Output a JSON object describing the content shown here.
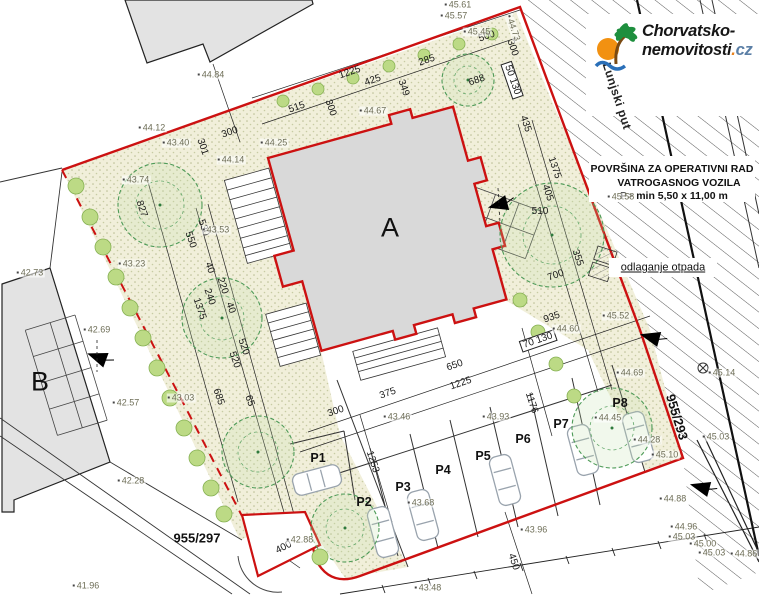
{
  "logo": {
    "brand_line1": "Chorvatsko-",
    "brand_line2": "nemovitosti",
    "brand_suffix_dot": ".",
    "brand_suffix": "cz",
    "icon": "palm-beach-icon",
    "accent_orange": "#e8821e",
    "accent_blue": "#5b7fa6"
  },
  "plan": {
    "boundary_color": "#cc1111",
    "building_fill": "#d9d9d9",
    "labels": [
      {
        "t": "A",
        "x": 390,
        "y": 228,
        "r": 0,
        "c": "bldg"
      },
      {
        "t": "B",
        "x": 40,
        "y": 382,
        "r": 0,
        "c": "bldg"
      },
      {
        "t": "955/297",
        "x": 197,
        "y": 538,
        "r": 0,
        "c": "parcel"
      },
      {
        "t": "955/293",
        "x": 677,
        "y": 417,
        "r": 73,
        "c": "parcel"
      },
      {
        "t": "Lunjski put",
        "x": 617,
        "y": 96,
        "r": 72,
        "c": "road"
      },
      {
        "t": "POVRŠINA ZA OPERATIVNI RAD",
        "x": 672,
        "y": 169,
        "r": 0,
        "c": "note"
      },
      {
        "t": "VATROGASNOG VOZILA",
        "x": 679,
        "y": 183,
        "r": 0,
        "c": "note"
      },
      {
        "t": "P> min 5,50 x 11,00 m",
        "x": 674,
        "y": 196,
        "r": 0,
        "c": "note"
      },
      {
        "t": "odlaganje otpada",
        "x": 663,
        "y": 268,
        "r": 0,
        "c": "noteu"
      },
      {
        "t": "P1",
        "x": 318,
        "y": 458,
        "r": 0,
        "c": "park"
      },
      {
        "t": "P2",
        "x": 364,
        "y": 502,
        "r": 0,
        "c": "park"
      },
      {
        "t": "P3",
        "x": 403,
        "y": 487,
        "r": 0,
        "c": "park"
      },
      {
        "t": "P4",
        "x": 443,
        "y": 470,
        "r": 0,
        "c": "park"
      },
      {
        "t": "P5",
        "x": 483,
        "y": 456,
        "r": 0,
        "c": "park"
      },
      {
        "t": "P6",
        "x": 523,
        "y": 439,
        "r": 0,
        "c": "park"
      },
      {
        "t": "P7",
        "x": 561,
        "y": 424,
        "r": 0,
        "c": "park"
      },
      {
        "t": "P8",
        "x": 620,
        "y": 403,
        "r": 0,
        "c": "park"
      },
      {
        "t": "500",
        "x": 487,
        "y": 37,
        "r": -19,
        "c": "dim"
      },
      {
        "t": "300",
        "x": 512,
        "y": 48,
        "r": 71,
        "c": "dim"
      },
      {
        "t": "285",
        "x": 427,
        "y": 61,
        "r": -19,
        "c": "dim"
      },
      {
        "t": "1225",
        "x": 350,
        "y": 73,
        "r": -19,
        "c": "dim"
      },
      {
        "t": "425",
        "x": 373,
        "y": 81,
        "r": -19,
        "c": "dim"
      },
      {
        "t": "349",
        "x": 403,
        "y": 88,
        "r": 71,
        "c": "dim"
      },
      {
        "t": "688",
        "x": 477,
        "y": 81,
        "r": -19,
        "c": "dim"
      },
      {
        "t": "515",
        "x": 297,
        "y": 108,
        "r": -19,
        "c": "dim"
      },
      {
        "t": "300",
        "x": 330,
        "y": 108,
        "r": 71,
        "c": "dim"
      },
      {
        "t": "50 130",
        "x": 512,
        "y": 80,
        "r": 71,
        "c": "dim boxed"
      },
      {
        "t": "435",
        "x": 525,
        "y": 124,
        "r": 71,
        "c": "dim"
      },
      {
        "t": "1375",
        "x": 554,
        "y": 168,
        "r": 71,
        "c": "dim"
      },
      {
        "t": "300",
        "x": 230,
        "y": 133,
        "r": -19,
        "c": "dim"
      },
      {
        "t": "301",
        "x": 202,
        "y": 147,
        "r": 71,
        "c": "dim"
      },
      {
        "t": "827",
        "x": 141,
        "y": 209,
        "r": 71,
        "c": "dim"
      },
      {
        "t": "530",
        "x": 203,
        "y": 228,
        "r": 71,
        "c": "dim"
      },
      {
        "t": "550",
        "x": 190,
        "y": 240,
        "r": 71,
        "c": "dim"
      },
      {
        "t": "40",
        "x": 209,
        "y": 268,
        "r": 71,
        "c": "dim"
      },
      {
        "t": "220",
        "x": 222,
        "y": 286,
        "r": 71,
        "c": "dim"
      },
      {
        "t": "240",
        "x": 209,
        "y": 297,
        "r": 71,
        "c": "dim"
      },
      {
        "t": "1375",
        "x": 199,
        "y": 309,
        "r": 71,
        "c": "dim"
      },
      {
        "t": "40",
        "x": 230,
        "y": 308,
        "r": 71,
        "c": "dim"
      },
      {
        "t": "520",
        "x": 243,
        "y": 347,
        "r": 71,
        "c": "dim"
      },
      {
        "t": "520",
        "x": 234,
        "y": 360,
        "r": 71,
        "c": "dim"
      },
      {
        "t": "685",
        "x": 218,
        "y": 397,
        "r": 71,
        "c": "dim"
      },
      {
        "t": "65",
        "x": 249,
        "y": 401,
        "r": 71,
        "c": "dim"
      },
      {
        "t": "405",
        "x": 547,
        "y": 193,
        "r": 71,
        "c": "dim"
      },
      {
        "t": "510",
        "x": 540,
        "y": 212,
        "r": 0,
        "c": "dim"
      },
      {
        "t": "355",
        "x": 577,
        "y": 258,
        "r": 71,
        "c": "dim"
      },
      {
        "t": "700",
        "x": 556,
        "y": 276,
        "r": -19,
        "c": "dim"
      },
      {
        "t": "935",
        "x": 552,
        "y": 318,
        "r": -19,
        "c": "dim"
      },
      {
        "t": "70 130",
        "x": 538,
        "y": 341,
        "r": -19,
        "c": "dim boxed"
      },
      {
        "t": "650",
        "x": 455,
        "y": 366,
        "r": -19,
        "c": "dim"
      },
      {
        "t": "1225",
        "x": 461,
        "y": 384,
        "r": -19,
        "c": "dim"
      },
      {
        "t": "375",
        "x": 388,
        "y": 394,
        "r": -19,
        "c": "dim"
      },
      {
        "t": "300",
        "x": 336,
        "y": 412,
        "r": -19,
        "c": "dim"
      },
      {
        "t": "1176",
        "x": 531,
        "y": 403,
        "r": 72,
        "c": "dim"
      },
      {
        "t": "1253",
        "x": 372,
        "y": 462,
        "r": 72,
        "c": "dim"
      },
      {
        "t": "450",
        "x": 513,
        "y": 562,
        "r": 72,
        "c": "dim"
      },
      {
        "t": "400",
        "x": 284,
        "y": 548,
        "r": -27,
        "c": "dim"
      },
      {
        "t": "45.61",
        "x": 458,
        "y": 5,
        "r": 0,
        "c": "lev"
      },
      {
        "t": "45.57",
        "x": 454,
        "y": 16,
        "r": 0,
        "c": "lev"
      },
      {
        "t": "44.84",
        "x": 211,
        "y": 75,
        "r": 0,
        "c": "lev"
      },
      {
        "t": "45.45",
        "x": 477,
        "y": 32,
        "r": 0,
        "c": "lev"
      },
      {
        "t": "44.73",
        "x": 513,
        "y": 28,
        "r": 71,
        "c": "lev"
      },
      {
        "t": "44.67",
        "x": 373,
        "y": 111,
        "r": 0,
        "c": "lev"
      },
      {
        "t": "44.12",
        "x": 152,
        "y": 128,
        "r": 0,
        "c": "lev"
      },
      {
        "t": "43.40",
        "x": 176,
        "y": 143,
        "r": 0,
        "c": "lev"
      },
      {
        "t": "44.25",
        "x": 274,
        "y": 143,
        "r": 0,
        "c": "lev"
      },
      {
        "t": "44.14",
        "x": 231,
        "y": 160,
        "r": 0,
        "c": "lev"
      },
      {
        "t": "43.74",
        "x": 136,
        "y": 180,
        "r": 0,
        "c": "lev"
      },
      {
        "t": "43.53",
        "x": 216,
        "y": 230,
        "r": 0,
        "c": "lev"
      },
      {
        "t": "43.23",
        "x": 132,
        "y": 264,
        "r": 0,
        "c": "lev"
      },
      {
        "t": "43.03",
        "x": 181,
        "y": 398,
        "r": 0,
        "c": "lev"
      },
      {
        "t": "42.69",
        "x": 97,
        "y": 330,
        "r": 0,
        "c": "lev"
      },
      {
        "t": "42.57",
        "x": 126,
        "y": 403,
        "r": 0,
        "c": "lev"
      },
      {
        "t": "42.73",
        "x": 30,
        "y": 273,
        "r": 0,
        "c": "lev"
      },
      {
        "t": "42.28",
        "x": 131,
        "y": 481,
        "r": 0,
        "c": "lev"
      },
      {
        "t": "41.96",
        "x": 86,
        "y": 586,
        "r": 0,
        "c": "lev"
      },
      {
        "t": "42.88",
        "x": 300,
        "y": 540,
        "r": 0,
        "c": "lev"
      },
      {
        "t": "43.46",
        "x": 397,
        "y": 417,
        "r": 0,
        "c": "lev"
      },
      {
        "t": "43.93",
        "x": 496,
        "y": 417,
        "r": 0,
        "c": "lev"
      },
      {
        "t": "43.68",
        "x": 421,
        "y": 503,
        "r": 0,
        "c": "lev"
      },
      {
        "t": "44.60",
        "x": 566,
        "y": 329,
        "r": 0,
        "c": "lev"
      },
      {
        "t": "45.52",
        "x": 616,
        "y": 316,
        "r": 0,
        "c": "lev"
      },
      {
        "t": "45.58",
        "x": 621,
        "y": 197,
        "r": 0,
        "c": "lev"
      },
      {
        "t": "44.69",
        "x": 630,
        "y": 373,
        "r": 0,
        "c": "lev"
      },
      {
        "t": "44.45",
        "x": 608,
        "y": 418,
        "r": 0,
        "c": "lev"
      },
      {
        "t": "44.28",
        "x": 647,
        "y": 440,
        "r": 0,
        "c": "lev"
      },
      {
        "t": "45.10",
        "x": 665,
        "y": 455,
        "r": 0,
        "c": "lev"
      },
      {
        "t": "44.88",
        "x": 673,
        "y": 499,
        "r": 0,
        "c": "lev"
      },
      {
        "t": "44.96",
        "x": 684,
        "y": 527,
        "r": 0,
        "c": "lev"
      },
      {
        "t": "45.03",
        "x": 682,
        "y": 537,
        "r": 0,
        "c": "lev"
      },
      {
        "t": "45.00",
        "x": 703,
        "y": 544,
        "r": 0,
        "c": "lev"
      },
      {
        "t": "45.03",
        "x": 712,
        "y": 553,
        "r": 0,
        "c": "lev"
      },
      {
        "t": "44.86",
        "x": 744,
        "y": 554,
        "r": 0,
        "c": "lev"
      },
      {
        "t": "43.96",
        "x": 534,
        "y": 530,
        "r": 0,
        "c": "lev"
      },
      {
        "t": "43.48",
        "x": 428,
        "y": 588,
        "r": 0,
        "c": "lev"
      },
      {
        "t": "45.14",
        "x": 722,
        "y": 373,
        "r": 0,
        "c": "lev"
      },
      {
        "t": "45.03",
        "x": 716,
        "y": 437,
        "r": 0,
        "c": "lev"
      }
    ]
  }
}
